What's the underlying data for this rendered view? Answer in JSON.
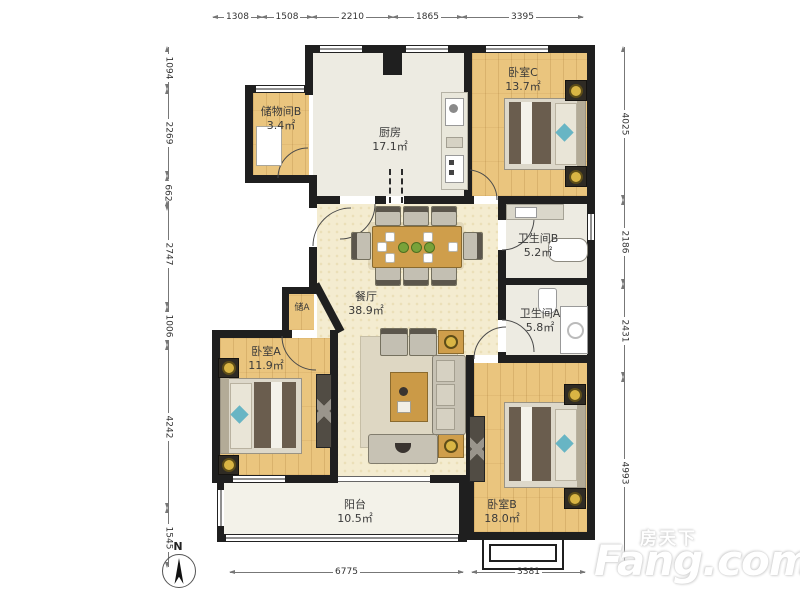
{
  "compass": {
    "label": "N"
  },
  "watermark": {
    "cn": "房天下",
    "en": "Fang.com"
  },
  "rooms": {
    "storage_b": {
      "name": "储物间B",
      "area": "3.4㎡"
    },
    "kitchen": {
      "name": "厨房",
      "area": "17.1㎡"
    },
    "bedroom_c": {
      "name": "卧室C",
      "area": "13.7㎡"
    },
    "bath_b": {
      "name": "卫生间B",
      "area": "5.2㎡"
    },
    "bath_a": {
      "name": "卫生间A",
      "area": "5.8㎡"
    },
    "dining": {
      "name": "餐厅",
      "area": "38.9㎡"
    },
    "storage_a": {
      "name": "储A"
    },
    "bedroom_a": {
      "name": "卧室A",
      "area": "11.9㎡"
    },
    "bedroom_b": {
      "name": "卧室B",
      "area": "18.0㎡"
    },
    "balcony": {
      "name": "阳台",
      "area": "10.5㎡"
    }
  },
  "dimensions": {
    "top": [
      "1308",
      "1508",
      "2210",
      "1865",
      "3395"
    ],
    "left": [
      "1094",
      "2269",
      "662",
      "2747",
      "1006",
      "4242",
      "1545"
    ],
    "right": [
      "4025",
      "2186",
      "2431",
      "4993"
    ],
    "bottom": [
      "6775",
      "3381"
    ]
  },
  "colors": {
    "wall": "#1f1f1f",
    "wood_floor": "#eac57e",
    "tile_floor": "#edebe2",
    "living_floor": "#f4ecd0",
    "accent_table": "#cf9e4b",
    "accent_teal": "#68b5c4"
  }
}
